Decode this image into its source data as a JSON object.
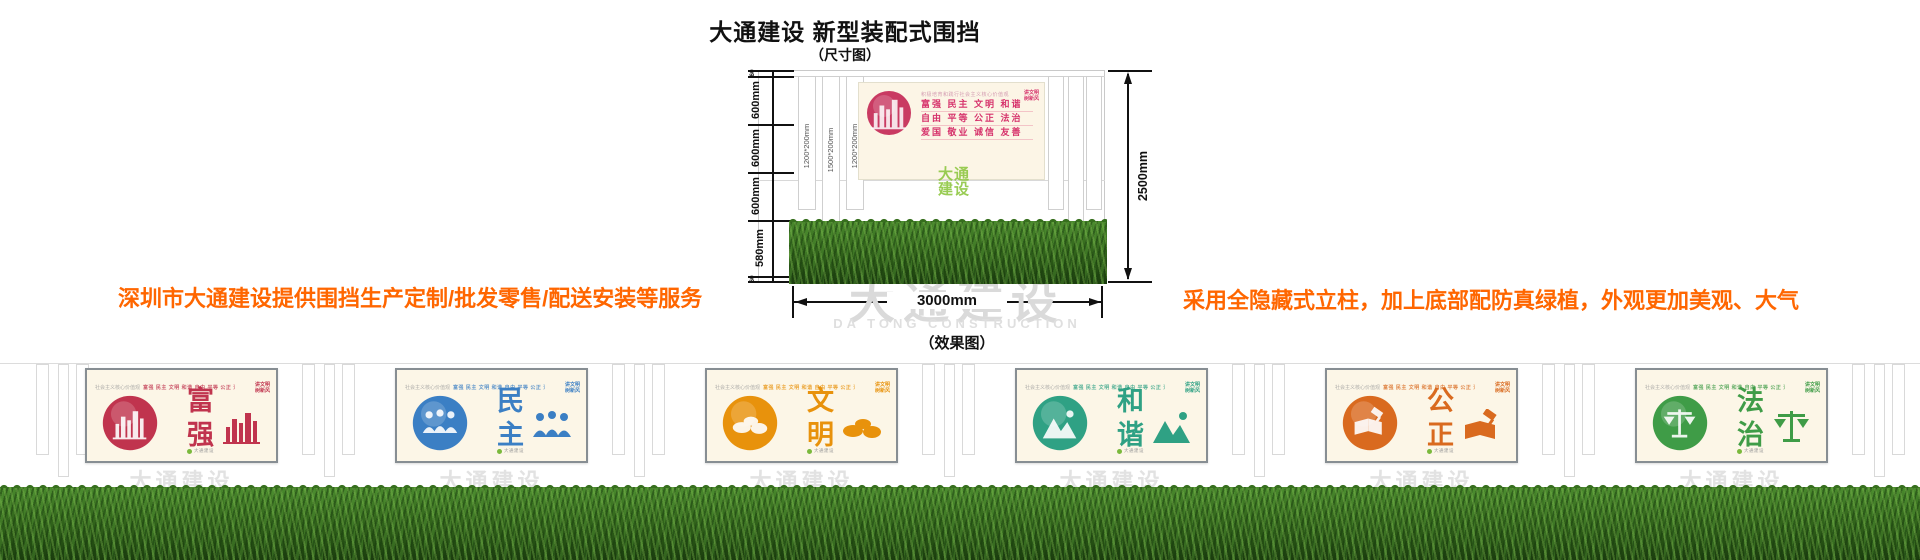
{
  "page": {
    "title": "大通建设 新型装配式围挡",
    "size_label": "（尺寸图）",
    "effect_label": "（效果图）"
  },
  "notes": {
    "left": "深圳市大通建设提供围挡生产定制/批发零售/配送安装等服务",
    "right": "采用全隐藏式立柱，加上底部配防真绿植，外观更加美观、大气",
    "color": "#ff6600"
  },
  "dimension_diagram": {
    "height_segments": [
      "60",
      "600mm",
      "600mm",
      "600mm",
      "580mm",
      "60"
    ],
    "total_height": "2500mm",
    "total_width": "3000mm",
    "post_labels": [
      "1200*200mm",
      "1500*200mm",
      "1200*200mm"
    ],
    "billboard": {
      "header": "积极培育和践行社会主义核心价值观",
      "value_rows": [
        "富强  民主  文明  和谐",
        "自由  平等  公正  法治",
        "爱国  敬业  诚信  友善"
      ],
      "badge": [
        "讲文明",
        "树新风"
      ],
      "accent": "#c93a62",
      "text_color": "#d6336c"
    },
    "corner_logo": [
      "大通",
      "建设"
    ],
    "corner_logo_color": "#8fc742"
  },
  "watermark": {
    "cn": "大通建设",
    "en": "DA TONG CONSTRUCTION"
  },
  "effect_view": {
    "top_row_header": "社会主义核心价值观",
    "top_row_values": "富强 民主 文明 和谐 自由 平等 公正 法治 爱国 敬业 诚信 友善",
    "badge": [
      "讲文明",
      "树新风"
    ],
    "panel_logo": "大通建设",
    "panels": [
      {
        "chars": "富强",
        "color": "#c0344e",
        "icon": "city-skyline-icon"
      },
      {
        "chars": "民主",
        "color": "#3b7fc4",
        "icon": "people-icon"
      },
      {
        "chars": "文明",
        "color": "#e8920c",
        "icon": "clouds-icon"
      },
      {
        "chars": "和谐",
        "color": "#2fa184",
        "icon": "mountains-icon"
      },
      {
        "chars": "公正",
        "color": "#d96a1f",
        "icon": "book-gavel-icon"
      },
      {
        "chars": "法治",
        "color": "#3f9c47",
        "icon": "scales-icon"
      }
    ]
  }
}
